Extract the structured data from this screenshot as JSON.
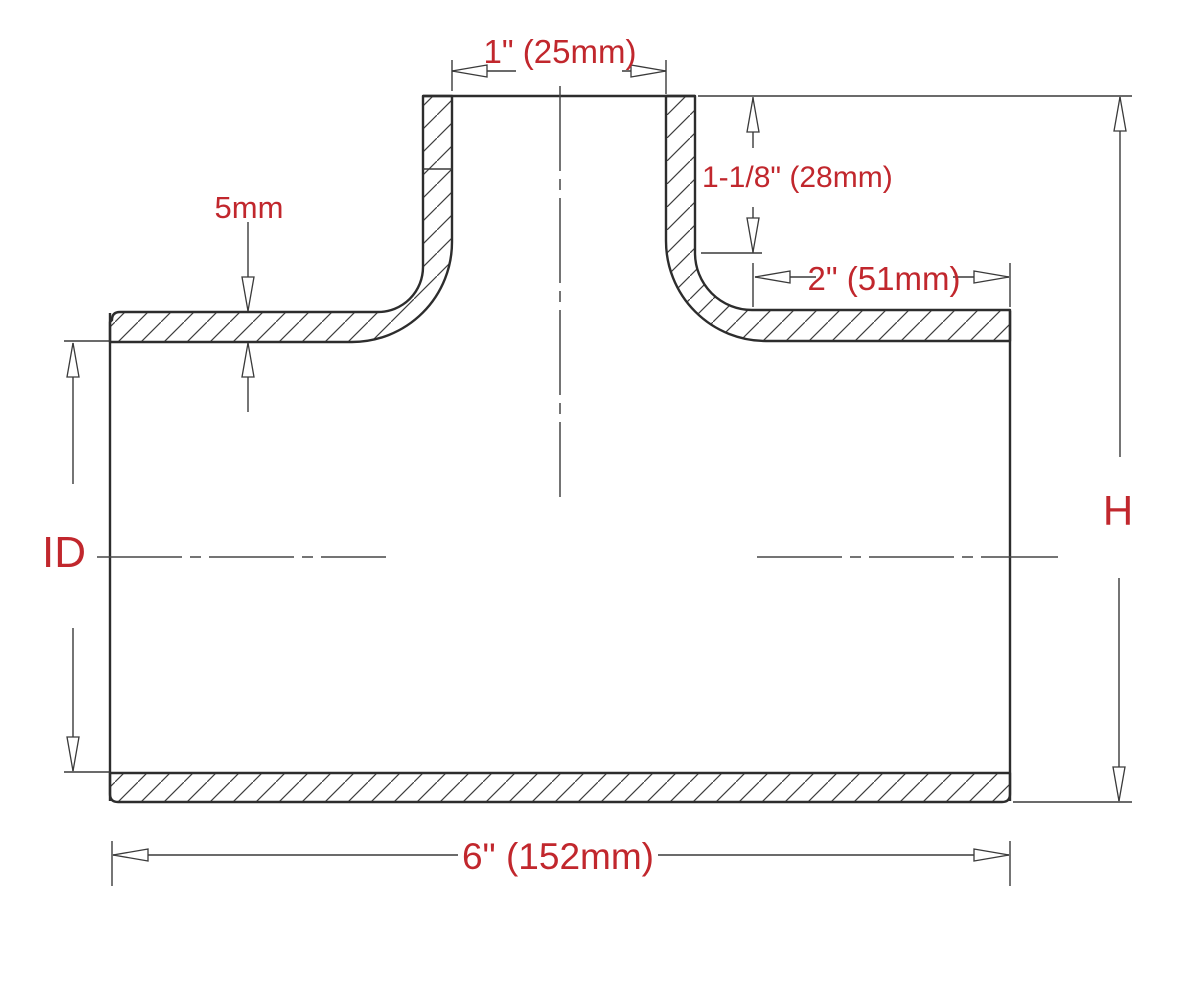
{
  "diagram": {
    "type": "engineering-cross-section",
    "subject": "T-pipe hose coupler section drawing",
    "dimensions": {
      "branch_inner_diameter": "1\" (25mm)",
      "branch_straight_length": "1-1/8\" (28mm)",
      "leg_straight_length": "2\" (51mm)",
      "wall_thickness": "5mm",
      "inner_diameter_label": "ID",
      "height_label": "H",
      "overall_length": "6\" (152mm)"
    },
    "colors": {
      "label_red": "#c1272d",
      "line_dark": "#2d2d2d",
      "background": "#ffffff"
    }
  }
}
